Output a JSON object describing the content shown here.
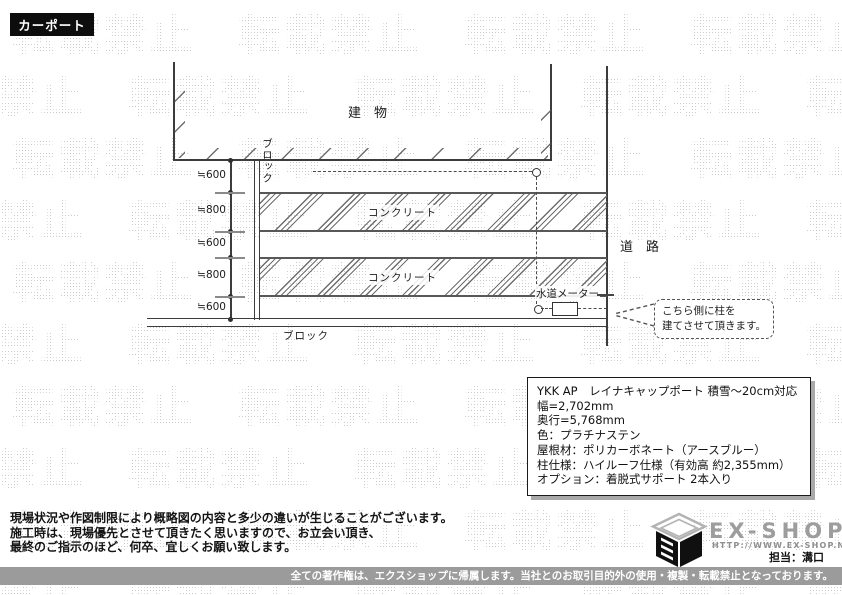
{
  "page_label": {
    "text": "カーポート"
  },
  "watermark": {
    "text": "転載禁止"
  },
  "diagram": {
    "building_label": "建　物",
    "road_label": "道　路",
    "block_label_vertical": "ブロック",
    "block_label_bottom": "ブロック",
    "concrete_label_1": "コンクリート",
    "concrete_label_2": "コンクリート",
    "water_meter_label": "水道メーター",
    "dimensions": [
      "≒600",
      "≒800",
      "≒600",
      "≒800",
      "≒600"
    ],
    "callout": {
      "line1": "こちら側に柱を",
      "line2": "建てさせて頂きます。"
    }
  },
  "spec_box": {
    "lines": [
      "YKK AP　レイナキャップポート 積雪～20cm対応",
      "幅=2,702mm",
      "奥行=5,768mm",
      "色：プラチナステン",
      "屋根材：ポリカーボネート（アースブルー）",
      "柱仕様：ハイルーフ仕様（有効高 約2,355mm）",
      "オプション：着脱式サポート 2本入り"
    ]
  },
  "notes": {
    "lines": [
      "現場状況や作図制限により概略図の内容と多少の違いが生じることがございます。",
      "施工時は、現場優先とさせて頂きたく思いますので、お立会い頂き、",
      "最終のご指示のほど、何卒、宜しくお願い致します。"
    ]
  },
  "footer": {
    "brand": "EX-SHOP",
    "url": "HTTP://WWW.EX-SHOP.NET",
    "agent": "担当：溝口",
    "copyright": "全ての著作権は、エクスショップに帰属します。当社とのお取引目的外の使用・複製・転載禁止となっております。"
  },
  "colors": {
    "line": "#3c3c3c",
    "watermark": "#cbcbcb",
    "badge_bg": "#0d0d0d",
    "bar_bg": "#9b9b9b",
    "brand_gray": "#9d9d9d"
  }
}
